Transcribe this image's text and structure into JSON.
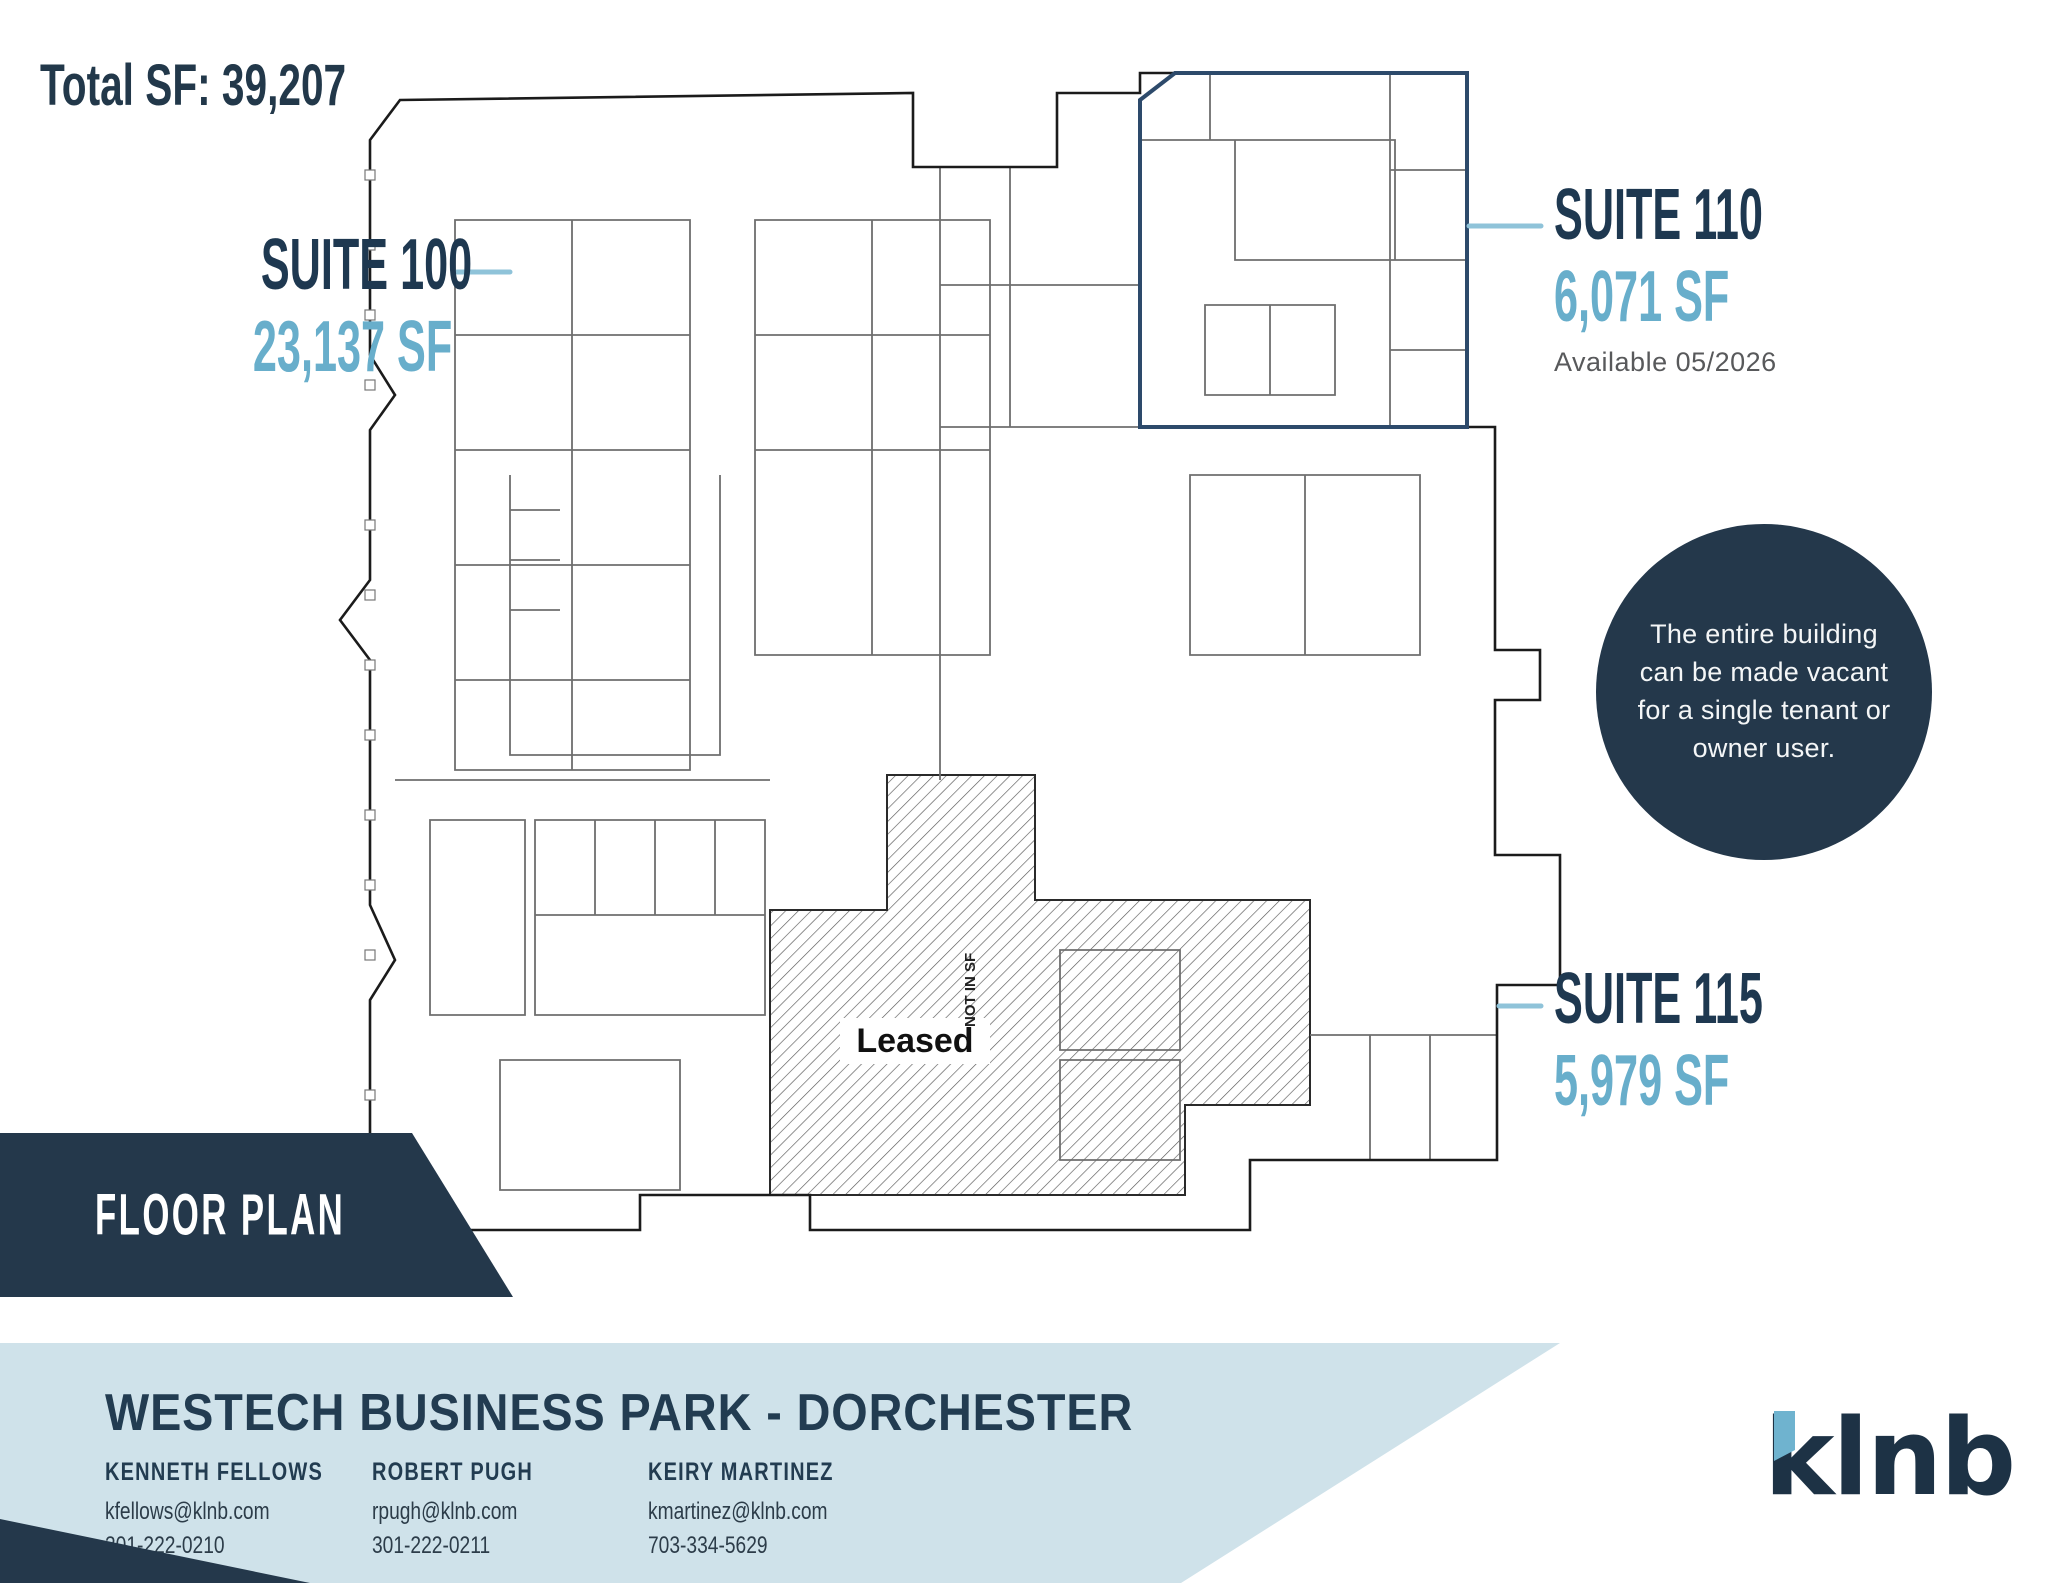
{
  "header": {
    "total_sf": "Total SF: 39,207"
  },
  "suites": {
    "s100": {
      "name": "SUITE 100",
      "sf": "23,137 SF"
    },
    "s110": {
      "name": "SUITE 110",
      "sf": "6,071 SF",
      "availability": "Available 05/2026"
    },
    "s115": {
      "name": "SUITE 115",
      "sf": "5,979 SF"
    }
  },
  "callout": {
    "text": "The entire building can be made vacant for a single tenant or owner user."
  },
  "plan": {
    "leased_label": "Leased",
    "not_in_sf_label": "NOT IN SF"
  },
  "banner": {
    "label": "FLOOR PLAN"
  },
  "footer": {
    "title": "WESTECH BUSINESS PARK - DORCHESTER",
    "contacts": [
      {
        "name": "KENNETH FELLOWS",
        "email": "kfellows@klnb.com",
        "phone": "301-222-0210"
      },
      {
        "name": "ROBERT PUGH",
        "email": "rpugh@klnb.com",
        "phone": "301-222-0211"
      },
      {
        "name": "KEIRY MARTINEZ",
        "email": "kmartinez@klnb.com",
        "phone": "703-334-5629"
      }
    ],
    "logo_text": "klnb"
  },
  "colors": {
    "navy": "#24384b",
    "text_navy": "#1e3850",
    "light_blue": "#68aecb",
    "band_blue": "#cfe2ea",
    "leader_blue": "#8fc3d9",
    "gray_text": "#58595b"
  }
}
